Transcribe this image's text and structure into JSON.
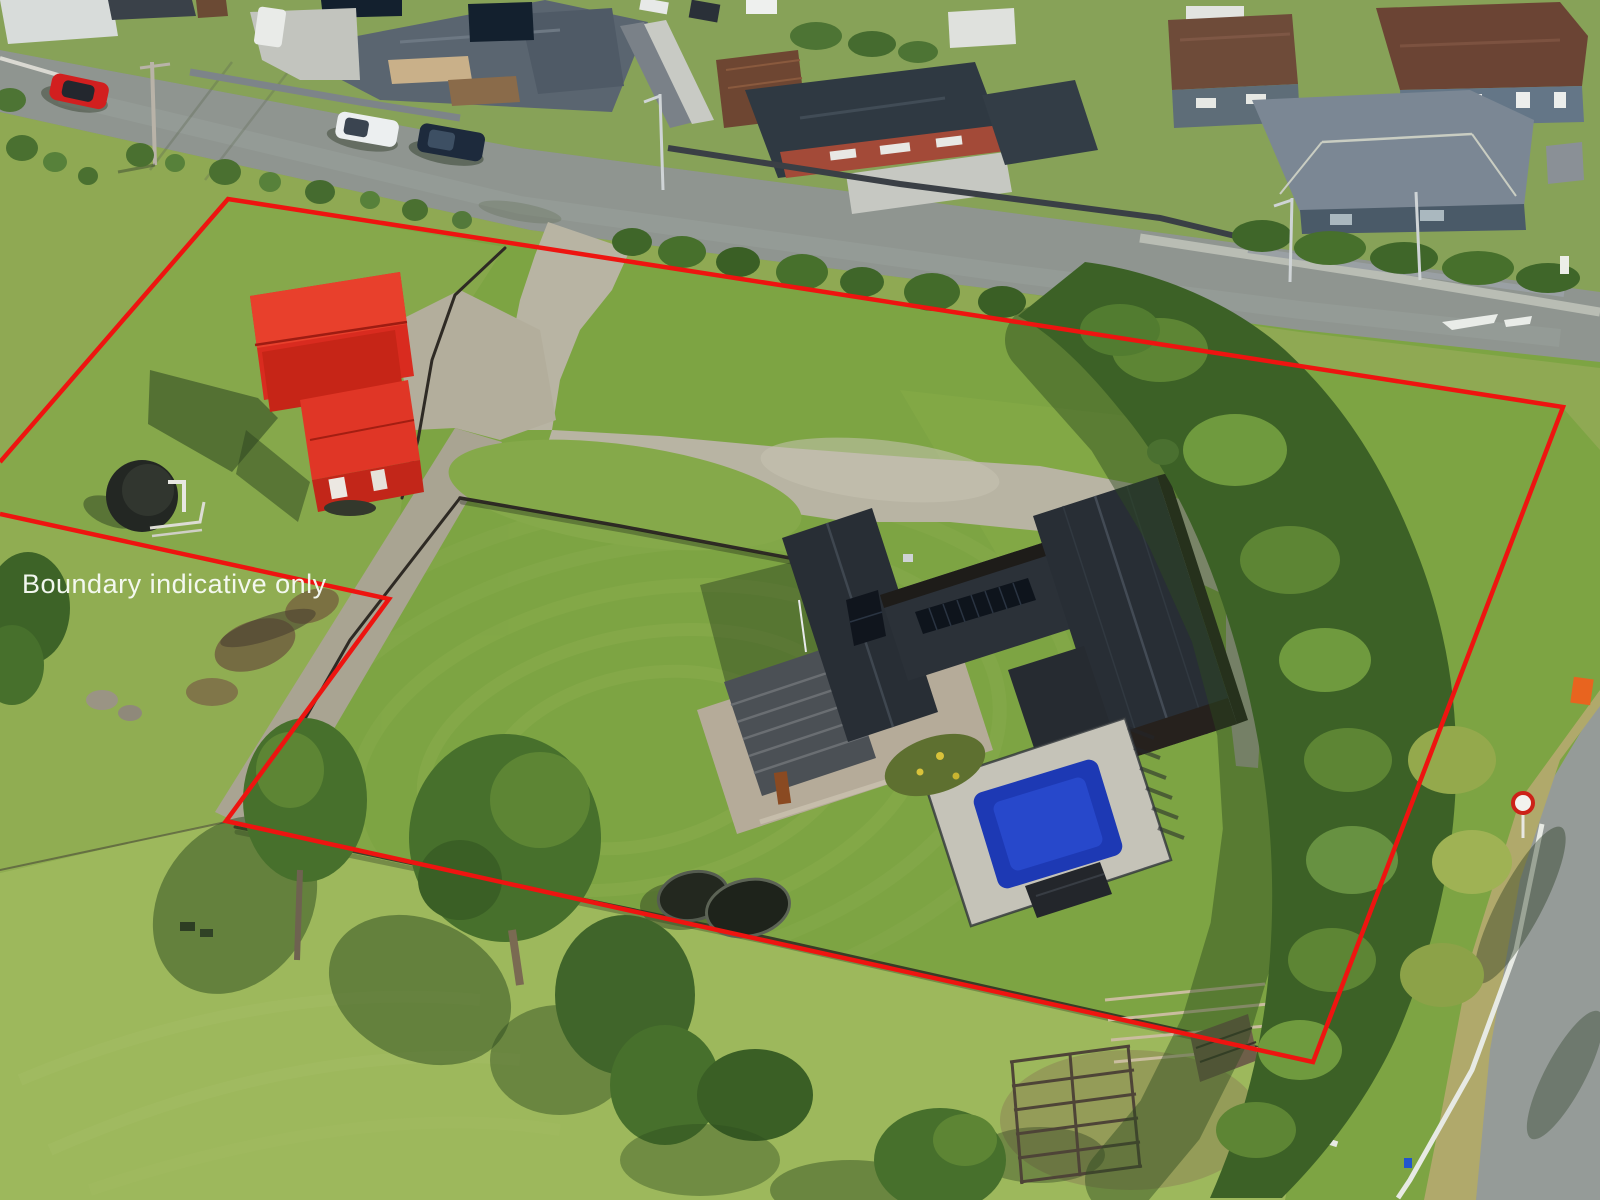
{
  "overlay": {
    "label": "Boundary indicative only",
    "label_color": "#f7fbf5",
    "label_font_size": 27,
    "label_x": 22,
    "label_y": 593,
    "boundary_color": "#ee1410",
    "boundary_stroke_width": 4.5,
    "boundary_points": "0,462 228,199 1563,407 1313,1062 226,821 389,599 0,514"
  },
  "palette": {
    "lawn_green": "#7da443",
    "pasture_light": "#9db85c",
    "tree_dark": "#3c6126",
    "road_asphalt": "#8f9590",
    "gravel": "#b8b4a3",
    "barn_red": "#d92b1f",
    "house_roof_black": "#282e35",
    "deck_timber": "#b5ab99",
    "pool_blue": "#1d39b4",
    "water_tank_black": "#232723"
  },
  "scene": {
    "type": "aerial-photograph",
    "features": [
      "residential street with parked cars",
      "red barn and red cottage",
      "black water tank",
      "gravel driveway and forecourt",
      "black-roof house with solar panels",
      "swimming pool",
      "trampolines",
      "stock yards",
      "tree shelter belt",
      "road with speed sign"
    ]
  }
}
